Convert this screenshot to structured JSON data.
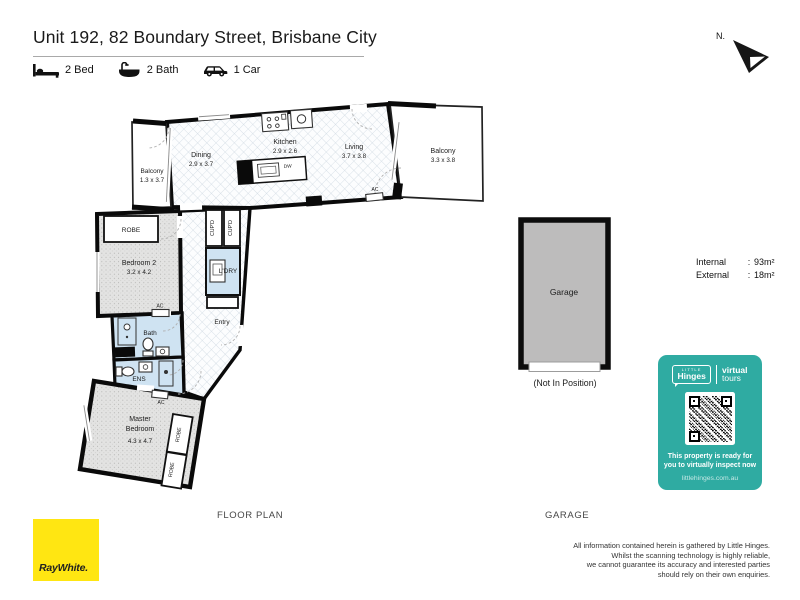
{
  "title": "Unit 192, 82 Boundary Street, Brisbane City",
  "features": [
    {
      "icon": "bed-icon",
      "label": "2 Bed"
    },
    {
      "icon": "bath-icon",
      "label": "2 Bath"
    },
    {
      "icon": "car-icon",
      "label": "1 Car"
    }
  ],
  "compass": {
    "label": "N."
  },
  "plan": {
    "caption": "FLOOR PLAN",
    "balcony_left": {
      "name": "Balcony",
      "dims": "1.3 x 3.7"
    },
    "dining": {
      "name": "Dining",
      "dims": "2.9 x 3.7"
    },
    "kitchen": {
      "name": "Kitchen",
      "dims": "2.9 x 2.6"
    },
    "living": {
      "name": "Living",
      "dims": "3.7 x 3.8"
    },
    "balcony_right": {
      "name": "Balcony",
      "dims": "3.3 x 3.8"
    },
    "bedroom2": {
      "name": "Bedroom 2",
      "dims": "3.2 x 4.2"
    },
    "master": {
      "line1": "Master",
      "line2": "Bedroom",
      "dims": "4.3 x 4.7"
    },
    "labels": {
      "bath": "Bath",
      "ens": "ENS",
      "laundry": "L'DRY",
      "entry": "Entry",
      "robe": "ROBE",
      "cupboard": "CUP'D",
      "ac": "AC",
      "dw": "DW"
    }
  },
  "garage": {
    "label": "Garage",
    "note": "(Not In Position)",
    "caption": "GARAGE"
  },
  "areas": {
    "internal_label": "Internal",
    "internal_value": "93m²",
    "external_label": "External",
    "external_value": "18m²",
    "colon": ":"
  },
  "hinges": {
    "little": "LITTLE",
    "brand": "Hinges",
    "word1": "virtual",
    "word2": "tours",
    "line1": "This property is ready for",
    "line2": "you to virtually inspect now",
    "site": "littlehinges.com.au",
    "bg": "#2FABA2"
  },
  "agency": {
    "name": "RayWhite.",
    "bg": "#FFE612"
  },
  "disclaimer": {
    "lines": [
      "All information contained herein is gathered by Little Hinges.",
      "Whilst the scanning technology is highly reliable,",
      "we cannot guarantee its accuracy and interested parties",
      "should rely on their own enquiries."
    ]
  }
}
